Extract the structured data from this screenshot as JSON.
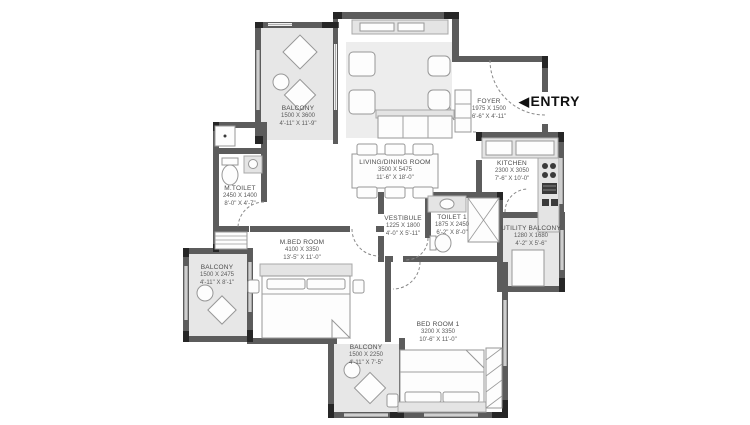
{
  "plan": {
    "entry_label": "ENTRY",
    "colors": {
      "wall": "#5c5c5c",
      "wall_dark": "#262626",
      "balcony_fill": "#e7e7e7",
      "text": "#4b4b4b",
      "entry_text": "#111111"
    },
    "rooms": [
      {
        "id": "balcony-top-left",
        "name": "BALCONY",
        "mm": "1500 X 3600",
        "ft": "4'-11\" X 11'-9\""
      },
      {
        "id": "living-dining",
        "name": "LIVING/DINING ROOM",
        "mm": "3500 X 5475",
        "ft": "11'-6\" X 18'-0\""
      },
      {
        "id": "foyer",
        "name": "FOYER",
        "mm": "1975 X 1500",
        "ft": "6'-6\" X 4'-11\""
      },
      {
        "id": "kitchen",
        "name": "KITCHEN",
        "mm": "2300 X 3050",
        "ft": "7'-6\" X 10'-0\""
      },
      {
        "id": "m-toilet",
        "name": "M.TOILET",
        "mm": "2450 X 1400",
        "ft": "8'-0\" X 4'-7\""
      },
      {
        "id": "vestibule",
        "name": "VESTIBULE",
        "mm": "1225 X 1800",
        "ft": "4'-0\" X 5'-11\""
      },
      {
        "id": "toilet-1",
        "name": "TOILET 1",
        "mm": "1875 X 2450",
        "ft": "6'-2\" X 8'-0\""
      },
      {
        "id": "utility-balcony",
        "name": "UTILITY BALCONY",
        "mm": "1280 X 1680",
        "ft": "4'-2\" X 5'-6\""
      },
      {
        "id": "m-bed-room",
        "name": "M.BED ROOM",
        "mm": "4100 X 3350",
        "ft": "13'-5\" X 11'-0\""
      },
      {
        "id": "balcony-left",
        "name": "BALCONY",
        "mm": "1500 X 2475",
        "ft": "4'-11\" X 8'-1\""
      },
      {
        "id": "balcony-bottom",
        "name": "BALCONY",
        "mm": "1500 X 2250",
        "ft": "4'-11\" X 7'-5\""
      },
      {
        "id": "bed-room-1",
        "name": "BED ROOM 1",
        "mm": "3200 X 3350",
        "ft": "10'-6\" X 11'-0\""
      }
    ]
  }
}
